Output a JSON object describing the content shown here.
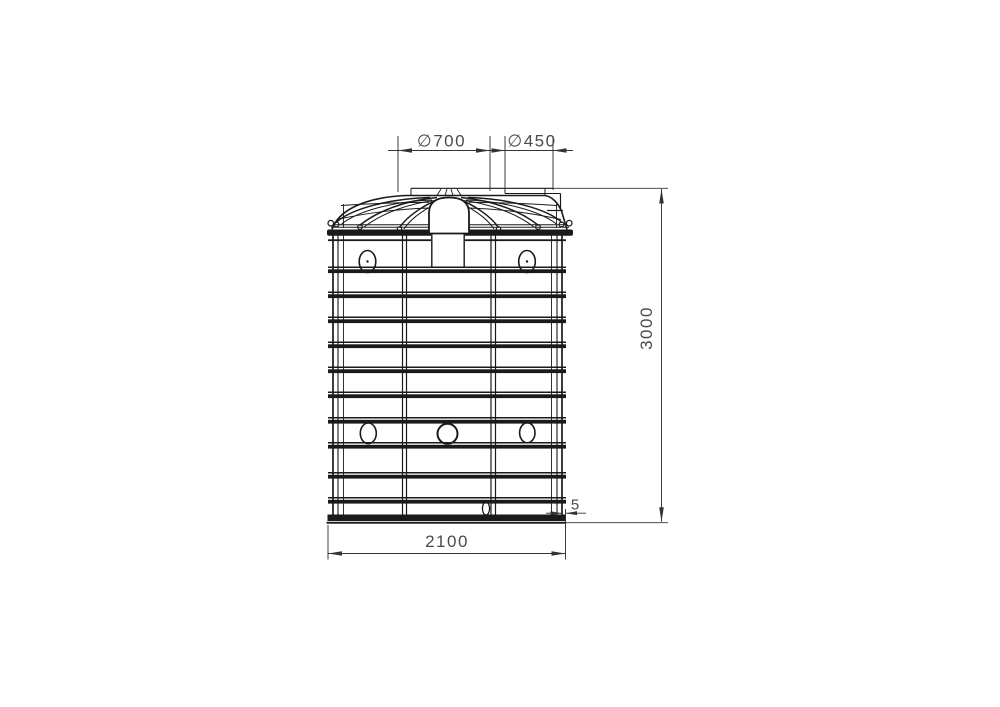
{
  "drawing": {
    "type": "tank-front-elevation",
    "colors": {
      "background": "#ffffff",
      "line": "#1a1a1a",
      "dimension_line": "#333333",
      "dimension_text": "#4a4a4a"
    },
    "dimensions": {
      "manhole_diameter": "∅700",
      "inlet_diameter": "∅450",
      "overall_height": "3000",
      "overall_width": "2100",
      "base_lip": "5"
    }
  }
}
